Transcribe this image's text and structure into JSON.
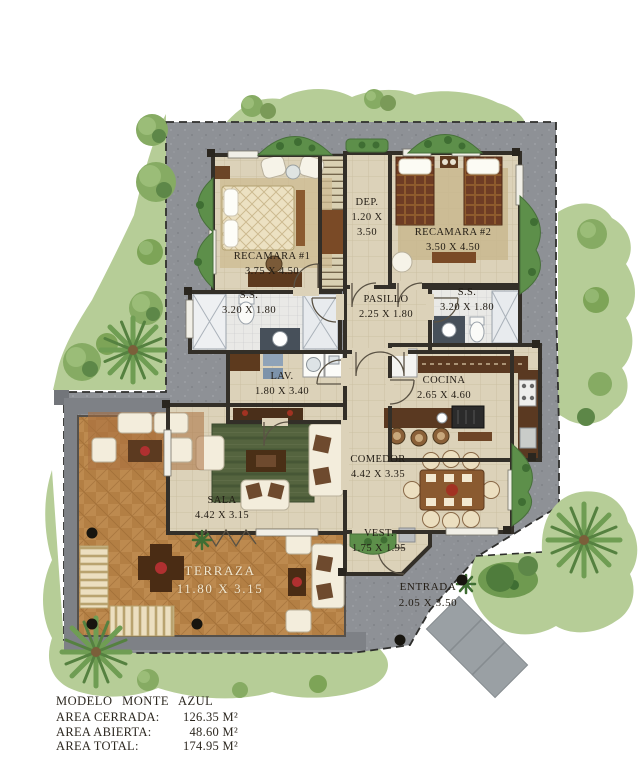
{
  "plan": {
    "title": "MODELO MONTE AZUL",
    "areas": [
      {
        "label": "AREA CERRADA:",
        "value": "126.35 M²"
      },
      {
        "label": "AREA ABIERTA:",
        "value": "48.60 M²"
      },
      {
        "label": "AREA TOTAL:",
        "value": "174.95 M²"
      }
    ]
  },
  "rooms": [
    {
      "id": "recamara1",
      "name": "RECAMARA #1",
      "dims": "3.75 X 4.50"
    },
    {
      "id": "dep",
      "name": "DEP.",
      "dims": "1.20 X 3.50"
    },
    {
      "id": "recamara2",
      "name": "RECAMARA #2",
      "dims": "3.50 X 4.50"
    },
    {
      "id": "ss-left",
      "name": "S.S.",
      "dims": "3.20 X 1.80"
    },
    {
      "id": "pasillo",
      "name": "PASILLO",
      "dims": "2.25 X 1.80"
    },
    {
      "id": "ss-right",
      "name": "S.S.",
      "dims": "3.20 X 1.80"
    },
    {
      "id": "lav",
      "name": "LAV.",
      "dims": "1.80 X 3.40"
    },
    {
      "id": "cocina",
      "name": "COCINA",
      "dims": "2.65 X 4.60"
    },
    {
      "id": "comedor",
      "name": "COMEDOR",
      "dims": "4.42 X 3.35"
    },
    {
      "id": "sala",
      "name": "SALA",
      "dims": "4.42 X 3.15"
    },
    {
      "id": "vest",
      "name": "VEST.",
      "dims": "1.75 X 1.95"
    },
    {
      "id": "terraza",
      "name": "TERRAZA",
      "dims": "11.80 X 3.15"
    },
    {
      "id": "entrada",
      "name": "ENTRADA",
      "dims": "2.05 X 3.50"
    }
  ],
  "colors": {
    "lawn": "#b6cd97",
    "plot_gravel": "#8e9196",
    "floor_tile": "#dcd2b9",
    "terrace_wood": "#bd8a4f",
    "wall": "#332f28",
    "label_text": "#221c14",
    "terraza_label_text": "#f0e7cf"
  }
}
